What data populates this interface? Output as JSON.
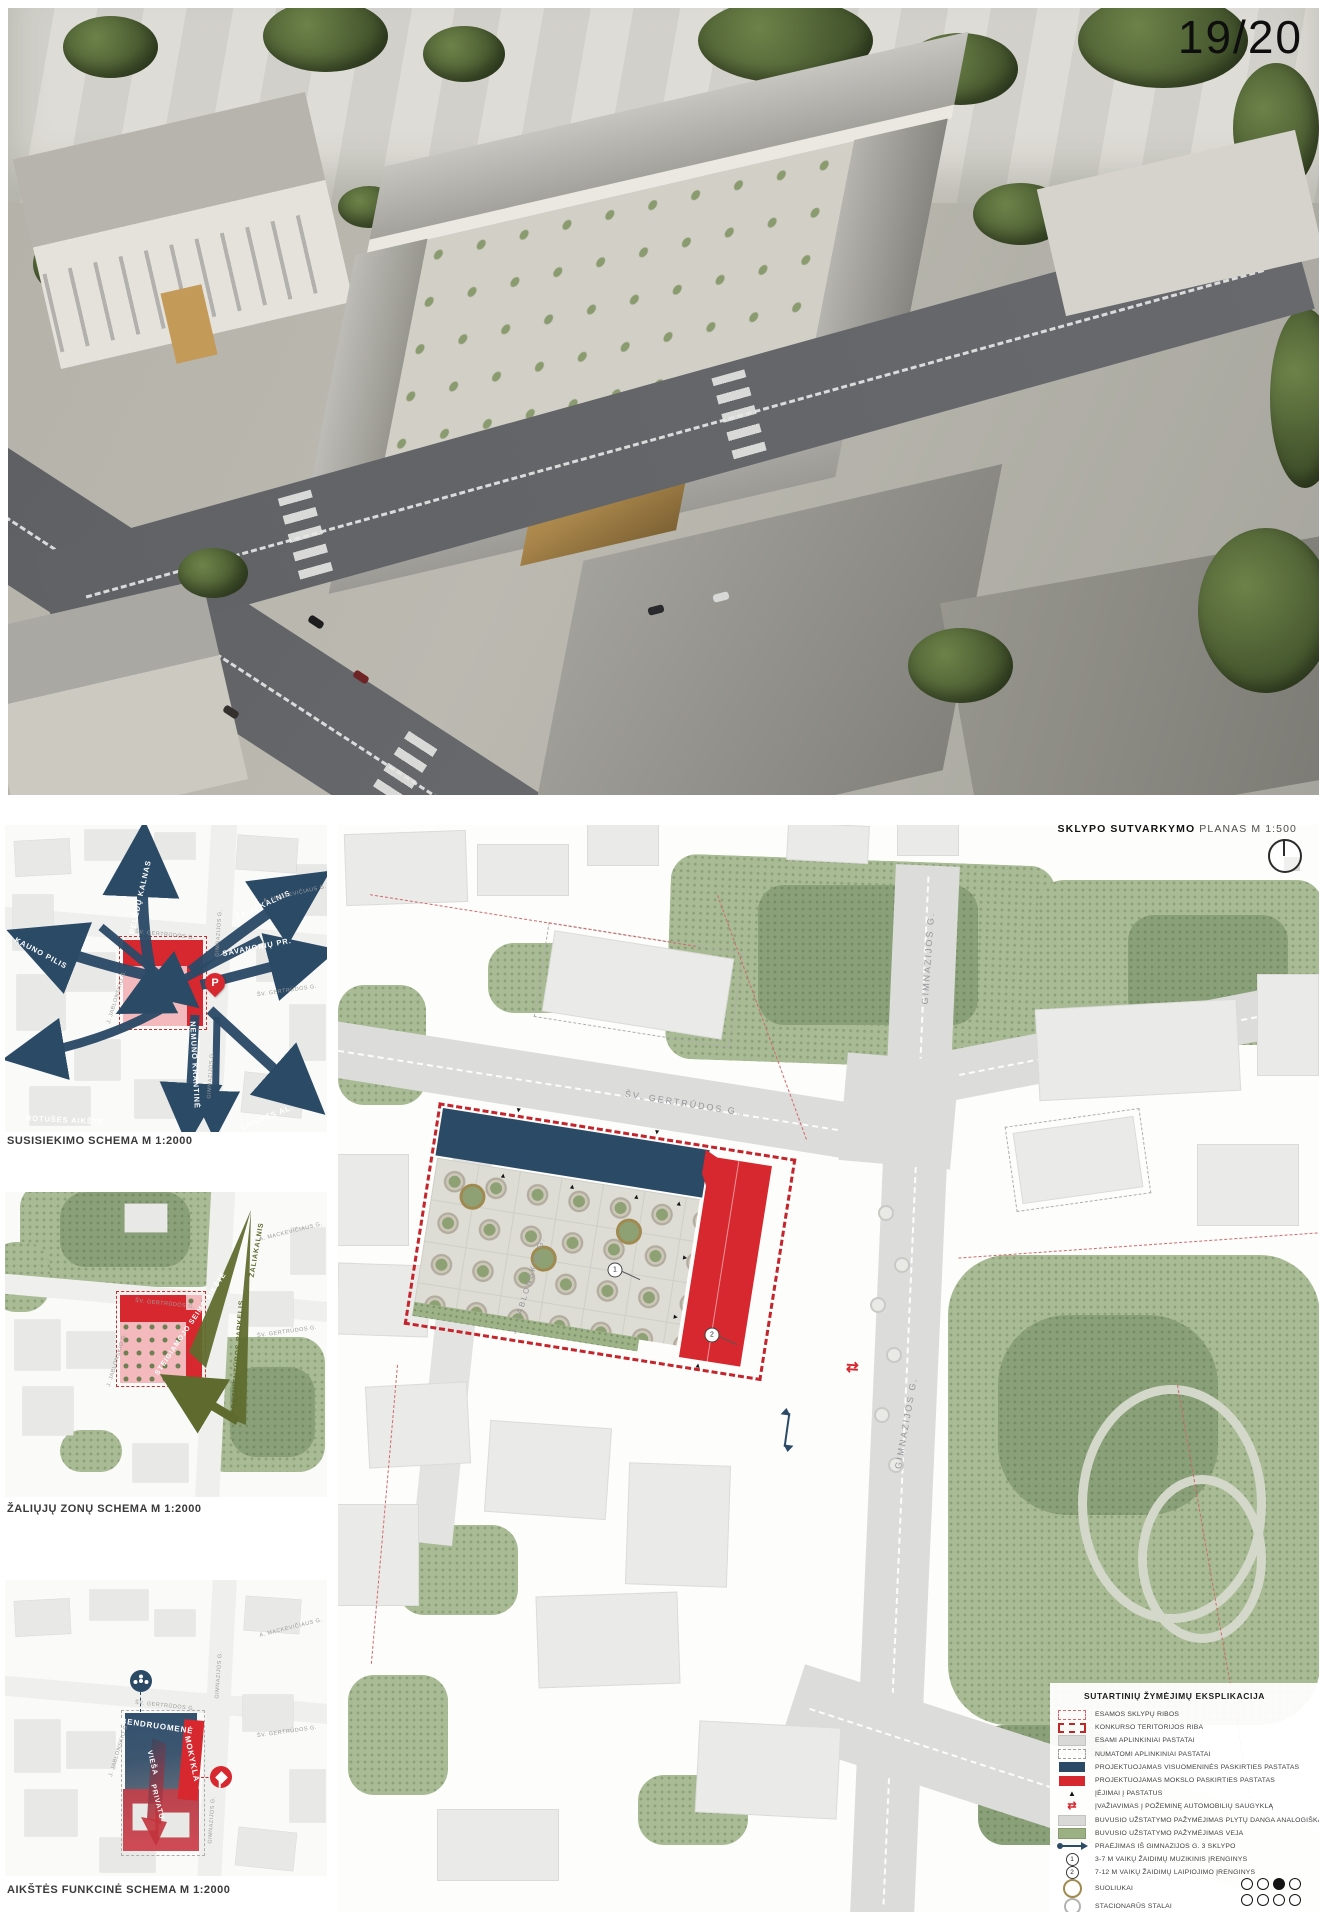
{
  "page": {
    "number": "19/20"
  },
  "figures": {
    "transport": {
      "caption": "SUSISIEKIMO SCHEMA M 1:2000",
      "labels": {
        "kauno_pilis": "KAUNO PILIS",
        "peledu_kalnas": "PELĖDŲ KALNAS",
        "zaliakalnis": "ŽALIAKALNIS",
        "savanoriu_pr": "SAVANORIŲ PR.",
        "nemuno_krantine": "NEMUNO KRANTINĖ",
        "laisves_al": "LAISVĖS AL.",
        "rotuses_aikste": "ROTUŠĖS AIKŠTĖ",
        "sv_gertrudos": "ŠV. GERTRŪDOS G.",
        "gimnazijos": "GIMNAZIJOS G.",
        "jablonskio": "J. JABLONSKIO G.",
        "mackeviciaus": "A. MACKEVIČIAUS G.",
        "parking": "P"
      }
    },
    "green": {
      "caption": "ŽALIŲJŲ ZONŲ SCHEMA M 1:2000",
      "labels": {
        "zaliakalnis": "ŽALIAKALNIS",
        "prezidenturos_parkelis": "PREZIDENTŪROS PARKELIS",
        "steigiamojo_seimo_aikste": "STEIGIAMOJO SEIMO AIKŠTĖ",
        "sv_gertrudos": "ŠV. GERTRŪDOS G.",
        "mackeviciaus": "A. MACKEVIČIAUS G.",
        "jablonskio": "J. JABLONSKIO G."
      }
    },
    "functional": {
      "caption": "AIKŠTĖS FUNKCINĖ SCHEMA M 1:2000",
      "labels": {
        "bendruomene": "BENDRUOMENĖ",
        "mokykla": "MOKYKLA",
        "viesa": "VIEŠA",
        "privatu": "PRIVATU",
        "sv_gertrudos": "ŠV. GERTRŪDOS G.",
        "gimnazijos": "GIMNAZIJOS G.",
        "jablonskio": "J. JABLONSKIO G.",
        "mackeviciaus": "A. MACKEVIČIAUS G."
      }
    }
  },
  "plan": {
    "title_bold": "SKLYPO SUTVARKYMO",
    "title_regular": "PLANAS M 1:500",
    "streets": {
      "sv_gertrudos": "ŠV. GERTRŪDOS G.",
      "gimnazijos_north": "GIMNAZIJOS G.",
      "gimnazijos_south": "GIMNAZIJOS G.",
      "jablonskio": "J. JABLONSKIO G."
    },
    "markers": {
      "playground_1": "1",
      "playground_2": "2"
    }
  },
  "legend": {
    "title": "SUTARTINIŲ ŽYMĖJIMŲ EKSPLIKACIJA",
    "items": [
      {
        "swatch": "thin-red-dashed-outline",
        "label": "ESAMOS SKLYPŲ RIBOS"
      },
      {
        "swatch": "thick-red-dashed-outline",
        "label": "KONKURSO TERITORIJOS RIBA"
      },
      {
        "swatch": "gray-fill",
        "label": "ESAMI APLINKINIAI PASTATAI"
      },
      {
        "swatch": "gray-dashed-outline",
        "label": "NUMATOMI APLINKINIAI PASTATAI"
      },
      {
        "swatch": "navy-fill",
        "label": "PROJEKTUOJAMAS VISUOMENINĖS PASKIRTIES PASTATAS"
      },
      {
        "swatch": "red-fill",
        "label": "PROJEKTUOJAMAS MOKSLO PASKIRTIES PASTATAS"
      },
      {
        "swatch": "black-triangle",
        "label": "ĮĖJIMAI Į PASTATUS"
      },
      {
        "swatch": "red-double-arrow",
        "label": "ĮVAŽIAVIMAS Į POŽEMINĘ AUTOMOBILIŲ SAUGYKLĄ"
      },
      {
        "swatch": "gray-fill",
        "label": "BUVUSIO UŽSTATYMO PAŽYMĖJIMAS PLYTŲ DANGA ANALOGIŠKA FASADAMS"
      },
      {
        "swatch": "green-fill",
        "label": "BUVUSIO UŽSTATYMO PAŽYMĖJIMAS VEJA"
      },
      {
        "swatch": "navy-line-arrow",
        "label": "PRAĖJIMAS IŠ GIMNAZIJOS G. 3 SKLYPO"
      },
      {
        "swatch": "circled-1",
        "label": "3-7 M VAIKŲ ŽAIDIMŲ MUZIKINIS ĮRENGINYS"
      },
      {
        "swatch": "circled-2",
        "label": "7-12 M VAIKŲ ŽAIDIMŲ LAIPIOJIMO ĮRENGINYS"
      },
      {
        "swatch": "tan-circle",
        "label": "SUOLIUKAI"
      },
      {
        "swatch": "gray-circle",
        "label": "STACIONARŪS STALAI"
      }
    ]
  },
  "pagination": {
    "total_dots": 8,
    "active_index": 2
  },
  "colors": {
    "navy": "#2B4A66",
    "red": "#D7282F",
    "pink": "#F3B9BC",
    "olive": "#5F6B2E",
    "green": "#A9BB94"
  }
}
